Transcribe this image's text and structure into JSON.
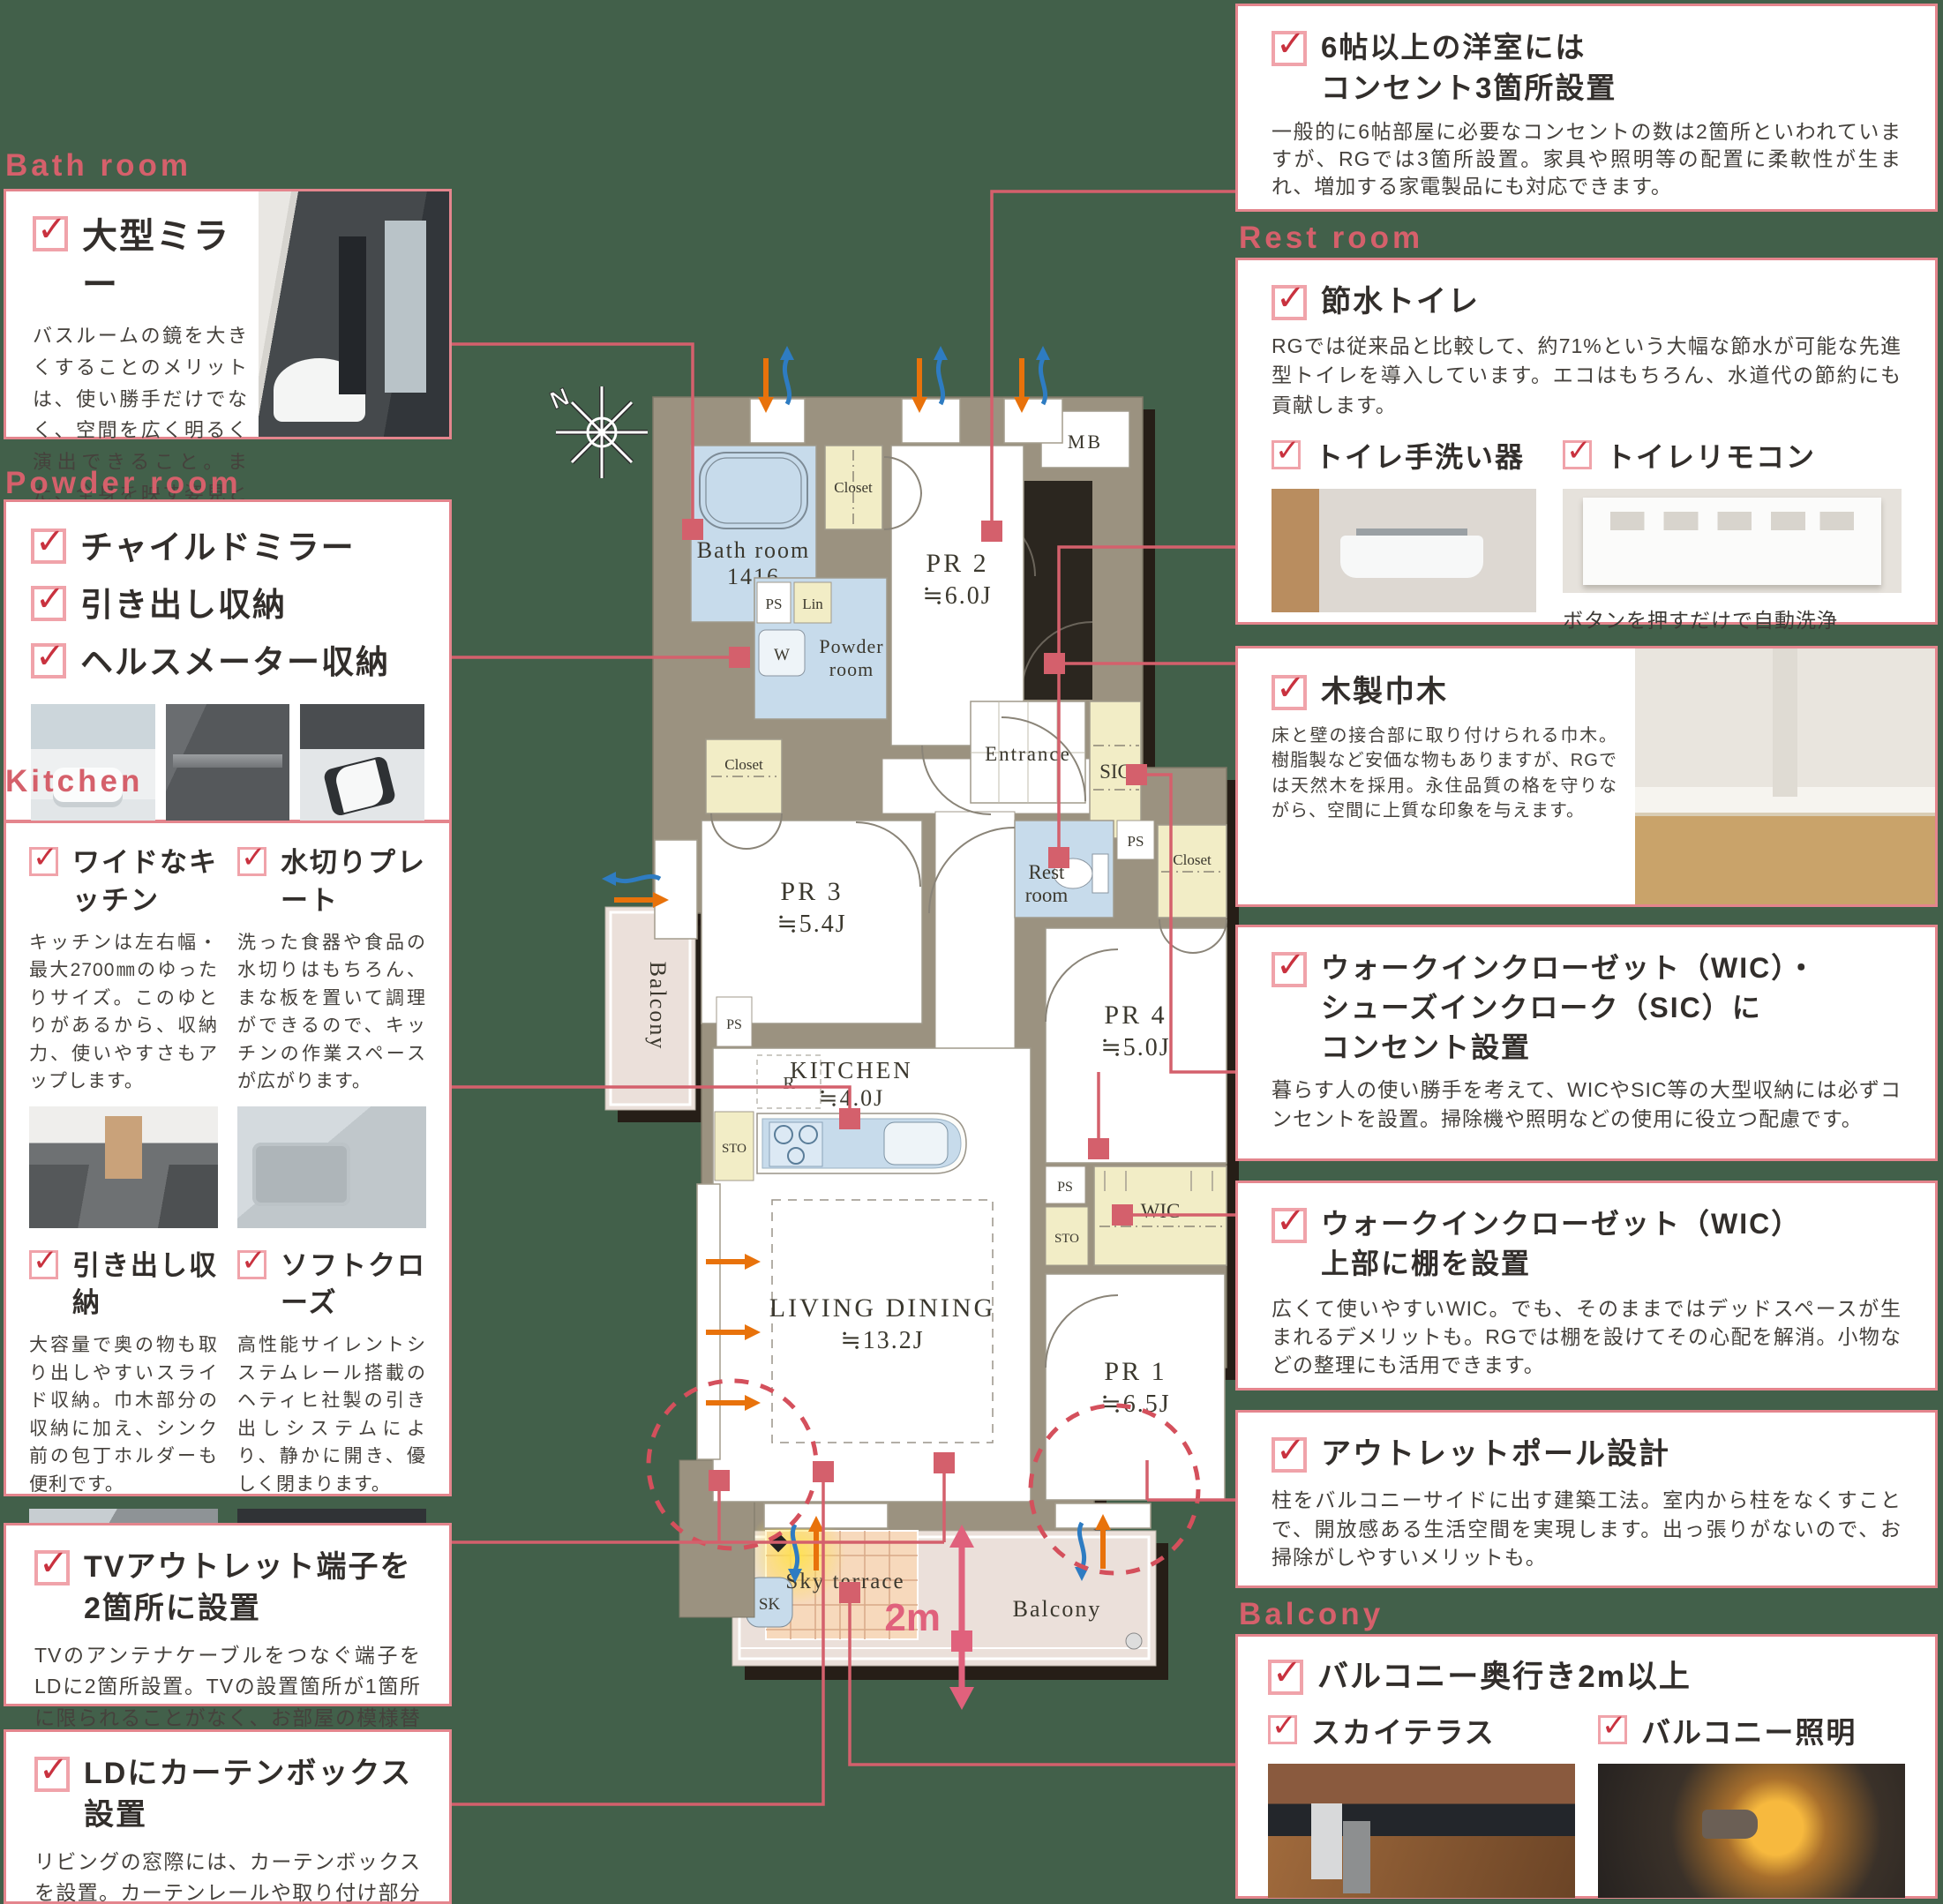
{
  "colors": {
    "background": "#42604a",
    "accent_pink": "#d5606b",
    "box_border": "#e4858d",
    "check_red": "#c9323f",
    "wall_olive": "#9b9280",
    "wet_blue": "#c7dbeb",
    "closet_yellow": "#f2edc6",
    "terrace_orange": "#f7d9bc",
    "balcony_beige": "#ebe0da"
  },
  "sections": {
    "bath_room": {
      "header": "Bath room",
      "title": "大型ミラー",
      "body": "バスルームの鏡を大きくすることのメリットは、使い勝手だけでなく、空間を広く明るく演出できること。また、全身を映す姿見として活用すれば身支度時に便利です。"
    },
    "powder_room": {
      "header": "Powder room",
      "items": [
        "チャイルドミラー",
        "引き出し収納",
        "ヘルスメーター収納"
      ]
    },
    "kitchen": {
      "header": "Kitchen",
      "features": [
        {
          "title": "ワイドなキッチン",
          "body": "キッチンは左右幅・最大2700㎜のゆったりサイズ。このゆとりがあるから、収納力、使いやすさもアップします。"
        },
        {
          "title": "水切りプレート",
          "body": "洗った食器や食品の水切りはもちろん、まな板を置いて調理ができるので、キッチンの作業スペースが広がります。"
        },
        {
          "title": "引き出し収納",
          "body": "大容量で奥の物も取り出しやすいスライド収納。巾木部分の収納に加え、シンク前の包丁ホルダーも便利です。"
        },
        {
          "title": "ソフトクローズ",
          "body": "高性能サイレントシステムレール搭載のヘティヒ社製の引き出しシステムにより、静かに開き、優しく閉まります。"
        }
      ]
    },
    "tv_outlet": {
      "title": "TVアウトレット端子を2箇所に設置",
      "body": "TVのアンテナケーブルをつなぐ端子をLDに2箇所設置。TVの設置箇所が1箇所に限られることがなく、お部屋の模様替えにも便利です。"
    },
    "curtain_box": {
      "title": "LDにカーテンボックス設置",
      "body": "リビングの窓際には、カーテンボックスを設置。カーテンレールや取り付け部分を隠せるので、お部屋の印象をすっきりとさせてお洒落な雰囲気を演出します。"
    },
    "outlet3": {
      "title_l1": "6帖以上の洋室には",
      "title_l2": "コンセント3箇所設置",
      "body": "一般的に6帖部屋に必要なコンセントの数は2箇所といわれていますが、RGでは3箇所設置。家具や照明等の配置に柔軟性が生まれ、増加する家電製品にも対応できます。"
    },
    "rest_room": {
      "header": "Rest room",
      "title": "節水トイレ",
      "body": "RGでは従来品と比較して、約71%という大幅な節水が可能な先進型トイレを導入しています。エコはもちろん、水道代の節約にも貢献します。",
      "sub1": "トイレ手洗い器",
      "sub2": "トイレリモコン",
      "caption": "ボタンを押すだけで自動洗浄"
    },
    "baseboard": {
      "title": "木製巾木",
      "body": "床と壁の接合部に取り付けられる巾木。樹脂製など安価な物もありますが、RGでは天然木を採用。永住品質の格を守りながら、空間に上質な印象を与えます。"
    },
    "wic_outlet": {
      "title_l1": "ウォークインクローゼット（WIC）・",
      "title_l2": "シューズインクローク（SIC）に",
      "title_l3": "コンセント設置",
      "body": "暮らす人の使い勝手を考えて、WICやSIC等の大型収納には必ずコンセントを設置。掃除機や照明などの使用に役立つ配慮です。"
    },
    "wic_shelf": {
      "title_l1": "ウォークインクローゼット（WIC）",
      "title_l2": "上部に棚を設置",
      "body": "広くて使いやすいWIC。でも、そのままではデッドスペースが生まれるデメリットも。RGでは棚を設けてその心配を解消。小物などの整理にも活用できます。"
    },
    "outlet_pole": {
      "title": "アウトレットポール設計",
      "body": "柱をバルコニーサイドに出す建築工法。室内から柱をなくすことで、開放感ある生活空間を実現します。出っ張りがないので、お掃除がしやすいメリットも。"
    },
    "balcony": {
      "header": "Balcony",
      "item1": "バルコニー奥行き2m以上",
      "item2": "スカイテラス",
      "item3": "バルコニー照明"
    }
  },
  "plan": {
    "compass_n": "N",
    "rooms": {
      "mb": "MB",
      "bath_l1": "Bath room",
      "bath_l2": "1416",
      "closet1": "Closet",
      "pr2_l1": "PR 2",
      "pr2_l2": "≒6.0J",
      "ps1": "PS",
      "lin": "Lin",
      "w": "W",
      "powder_l1": "Powder",
      "powder_l2": "room",
      "closet2": "Closet",
      "pr3_l1": "PR 3",
      "pr3_l2": "≒5.4J",
      "entrance": "Entrance",
      "sic": "SIC",
      "rest_l1": "Rest",
      "rest_l2": "room",
      "ps2": "PS",
      "closet3": "Closet",
      "pr4_l1": "PR 4",
      "pr4_l2": "≒5.0J",
      "kitchen_l1": "KITCHEN",
      "kitchen_l2": "≒4.0J",
      "r": "R",
      "ps3": "PS",
      "sto1": "STO",
      "ps4": "PS",
      "sto2": "STO",
      "wic": "WIC",
      "ld_l1": "LIVING DINING",
      "ld_l2": "≒13.2J",
      "pr1_l1": "PR 1",
      "pr1_l2": "≒6.5J",
      "balcony_left": "Balcony",
      "sky_terrace": "Sky terrace",
      "sk": "SK",
      "balcony_bottom": "Balcony",
      "dim_2m": "2m"
    }
  }
}
